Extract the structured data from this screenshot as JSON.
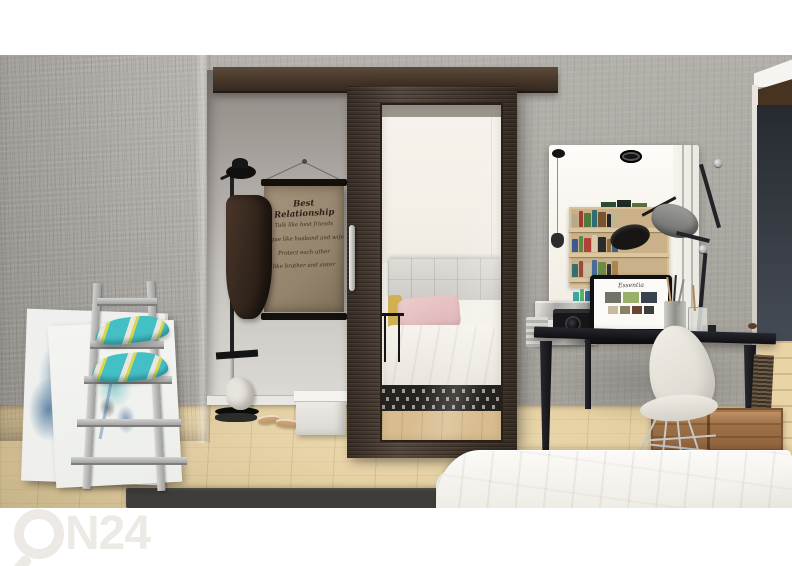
{
  "scene": {
    "type": "interior product photograph",
    "objects": [
      "concrete wall",
      "sliding wardrobe door with mirror",
      "door track rail",
      "wall poster",
      "coat stand with coat and hat",
      "ladder shelf with pillows",
      "abstract canvases",
      "vanity wall mirror",
      "bookshelf reflection",
      "desk lamp",
      "black desk",
      "laptop",
      "metal storage box",
      "camera",
      "pen cups",
      "white shell chair",
      "wooden crate",
      "white bed duvet",
      "wood floor",
      "dark rug",
      "white storage box",
      "sandals",
      "paper bag"
    ]
  },
  "watermark": {
    "brand": "ON24",
    "icon": "magnifier-o-icon",
    "text_after_icon": "N24",
    "color": "#edeae5"
  },
  "poster": {
    "title": "Best Relationship",
    "lines": [
      "Talk like best friends",
      "Argue like husband and wife",
      "Protect each other",
      "like brother and sister"
    ],
    "paper_color": "#a2927b",
    "text_color": "#30201a"
  },
  "laptop": {
    "screen_title": "Essentia",
    "thumb_colors": [
      "#6f7466",
      "#9ab06a",
      "#39434d"
    ],
    "thumb_colors_small": [
      "#c9b9a0",
      "#8c8066",
      "#6b4434",
      "#3d3d3d"
    ]
  },
  "vanity_mirror": {
    "book_rows": [
      [
        "#b7a98c",
        "#a33b2e",
        "#4e7a3a",
        "#2e6e73",
        "#7a5231",
        "#23242a",
        "#c2b48f"
      ],
      [
        "#3c5a8c",
        "#5b8a46",
        "#b04038",
        "#d9cba8",
        "#2b2b2b",
        "#8a6a3f",
        "#46607a"
      ],
      [
        "#356e6e",
        "#9a4a3a",
        "#c9bfa0",
        "#4a6a9a",
        "#6b8a4a",
        "#2f2f33",
        "#a8864f"
      ]
    ],
    "bottom_row": [
      "#3aa8a0",
      "#5bb06a",
      "#2e6e9a",
      "#c9c06a",
      "#3a3a3a",
      "#76c9c0",
      "#b0543a"
    ]
  },
  "palette": {
    "door_wood": "#4a3d32",
    "track": "#473729",
    "concrete": "#a9a6a0",
    "alcove_wall": "#c6c2bd",
    "floor_wood": "#e2cda0",
    "rug": "#3e3d39",
    "duvet": "#f7f5f1",
    "desk": "#17171c",
    "charcoal_wall": "#3a3f47",
    "pillow_teal": "#45bfc6",
    "pillow_yellow": "#d8d84f",
    "pink_pillow": "#e3bfc0",
    "crate": "#9c6f45",
    "chair_shell": "#e9e6df"
  }
}
